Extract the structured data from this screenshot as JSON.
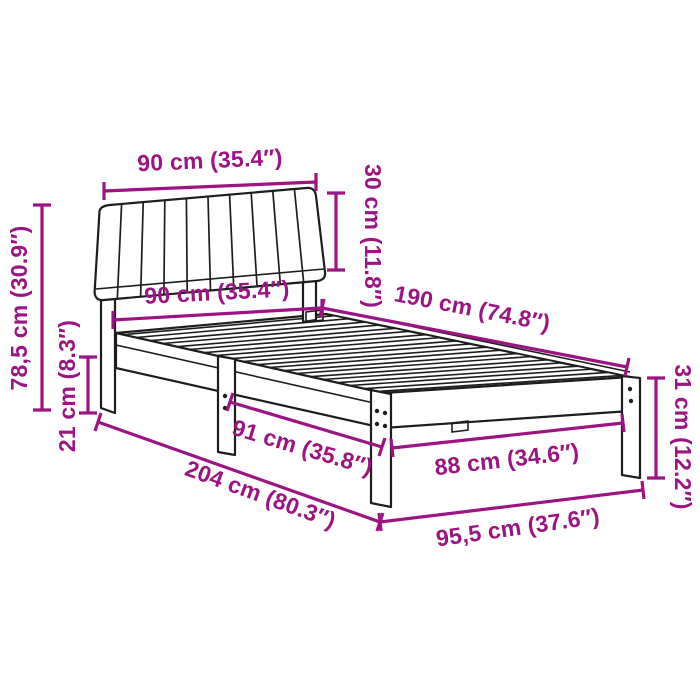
{
  "illustration": {
    "description": "line drawing of a bed frame with an upholstered channel-tufted headboard, slatted base and wooden legs, shown in perspective"
  },
  "colors": {
    "dimension": "#9b1482",
    "line_art": "#1d1d1b",
    "background": "#ffffff"
  },
  "dimensions": [
    {
      "id": "headboard-width-top",
      "label": "90 cm (35.4″)"
    },
    {
      "id": "headboard-height",
      "label": "30 cm (11.8″)"
    },
    {
      "id": "total-height",
      "label": "78,5 cm (30.9″)"
    },
    {
      "id": "under-bed-clearance",
      "label": "21 cm (8.3″)"
    },
    {
      "id": "headboard-width-inner",
      "label": "90 cm (35.4″)"
    },
    {
      "id": "sleeping-length",
      "label": "190 cm (74.8″)"
    },
    {
      "id": "foot-end-height",
      "label": "31 cm (12.2″)"
    },
    {
      "id": "foot-leg-span",
      "label": "88 cm (34.6″)"
    },
    {
      "id": "head-leg-span",
      "label": "91 cm (35.8″)"
    },
    {
      "id": "total-length",
      "label": "204 cm (80.3″)"
    },
    {
      "id": "total-width",
      "label": "95,5 cm (37.6″)"
    }
  ]
}
